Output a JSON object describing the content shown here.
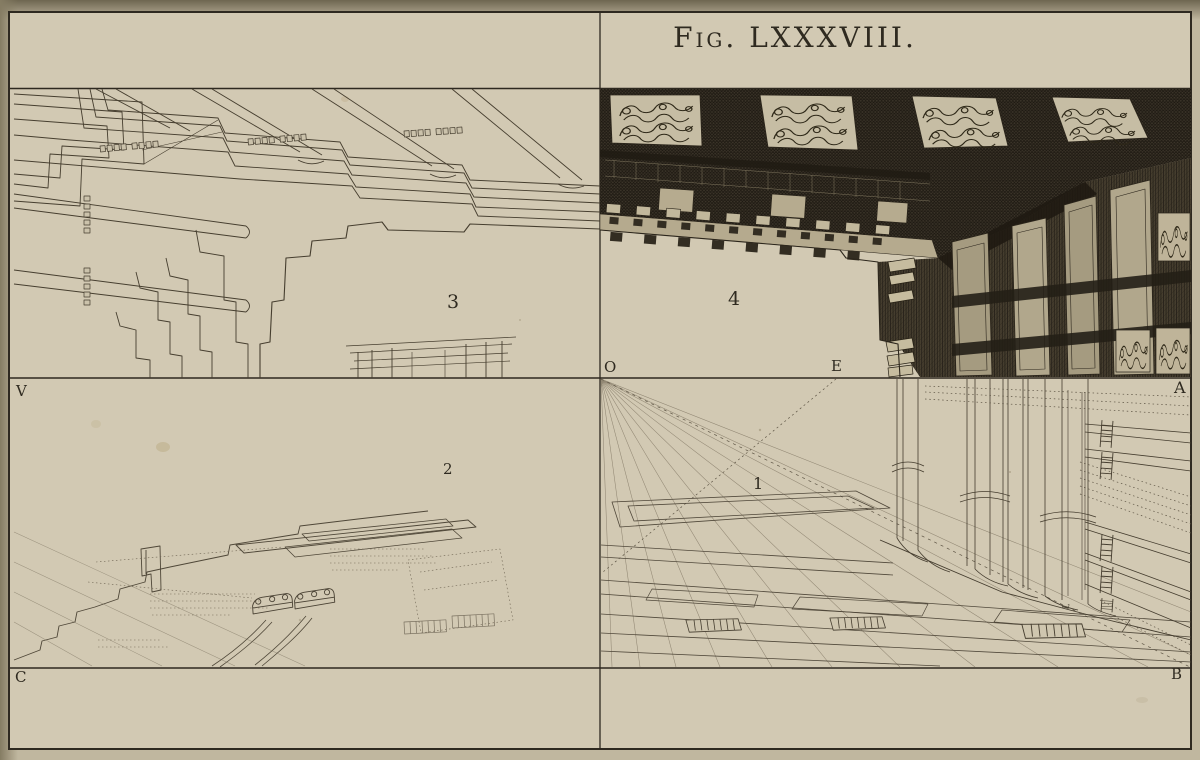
{
  "figure": {
    "title": "Fig. LXXXVIII."
  },
  "quadrant_labels": {
    "one": "1",
    "two": "2",
    "three": "3",
    "four": "4"
  },
  "point_labels": {
    "o": "O",
    "e": "E",
    "a": "A",
    "v": "V",
    "c": "C",
    "b": "B",
    "floor_mark": "L"
  },
  "colors": {
    "paper": "#d2c9b3",
    "margin": "#c0b79f",
    "ink": "#3a332a",
    "engraving_dark": "#3c352a"
  }
}
